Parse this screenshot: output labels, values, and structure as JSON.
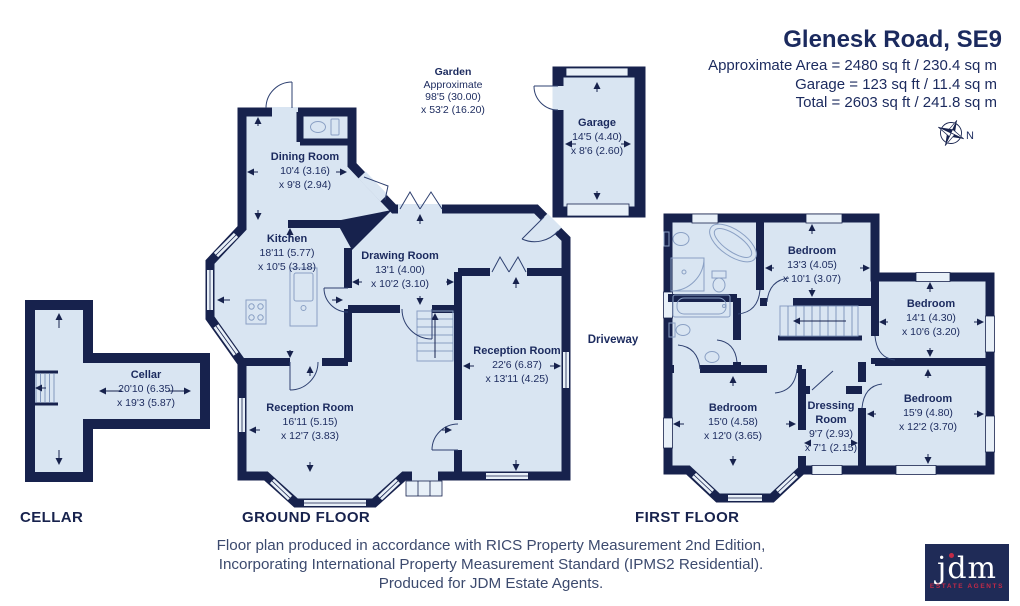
{
  "header": {
    "title": "Glenesk Road, SE9",
    "area_line1": "Approximate Area = 2480 sq ft / 230.4 sq m",
    "area_line2": "Garage = 123 sq ft / 11.4 sq m",
    "area_line3": "Total = 2603 sq ft / 241.8 sq m",
    "compass_n": "N"
  },
  "labels": {
    "garden_1": "Garden",
    "garden_2": "Approximate",
    "garden_3": "98'5 (30.00)",
    "garden_4": "x 53'2 (16.20)",
    "driveway": "Driveway",
    "floor_cellar": "CELLAR",
    "floor_ground": "GROUND FLOOR",
    "floor_first": "FIRST FLOOR"
  },
  "rooms": {
    "cellar": {
      "name": "Cellar",
      "d1": "20'10 (6.35)",
      "d2": "x 19'3 (5.87)"
    },
    "garage": {
      "name": "Garage",
      "d1": "14'5 (4.40)",
      "d2": "x 8'6 (2.60)"
    },
    "dining": {
      "name": "Dining Room",
      "d1": "10'4 (3.16)",
      "d2": "x 9'8 (2.94)"
    },
    "kitchen": {
      "name": "Kitchen",
      "d1": "18'11 (5.77)",
      "d2": "x 10'5 (3.18)"
    },
    "drawing": {
      "name": "Drawing Room",
      "d1": "13'1 (4.00)",
      "d2": "x 10'2 (3.10)"
    },
    "reception1": {
      "name": "Reception Room",
      "d1": "22'6 (6.87)",
      "d2": "x 13'11 (4.25)"
    },
    "reception2": {
      "name": "Reception Room",
      "d1": "16'11 (5.15)",
      "d2": "x 12'7 (3.83)"
    },
    "bedroom1": {
      "name": "Bedroom",
      "d1": "13'3 (4.05)",
      "d2": "x 10'1 (3.07)"
    },
    "bedroom2": {
      "name": "Bedroom",
      "d1": "14'1 (4.30)",
      "d2": "x 10'6 (3.20)"
    },
    "bedroom3": {
      "name": "Bedroom",
      "d1": "15'0 (4.58)",
      "d2": "x 12'0 (3.65)"
    },
    "dressing": {
      "name": "Dressing Room",
      "d1": "9'7 (2.93)",
      "d2": "x 7'1 (2.15)"
    },
    "bedroom4": {
      "name": "Bedroom",
      "d1": "15'9 (4.80)",
      "d2": "x 12'2 (3.70)"
    }
  },
  "footer": {
    "line1": "Floor plan produced in accordance with RICS Property Measurement 2nd Edition,",
    "line2": "Incorporating International Property Measurement Standard (IPMS2 Residential).",
    "line3": "Produced for JDM Estate Agents."
  },
  "logo": {
    "name": "jdm",
    "tagline": "ESTATE AGENTS"
  },
  "colors": {
    "wall": "#17224d",
    "floor": "#d9e5f2",
    "accent_red": "#c22a47",
    "text": "#1b2a5e"
  }
}
